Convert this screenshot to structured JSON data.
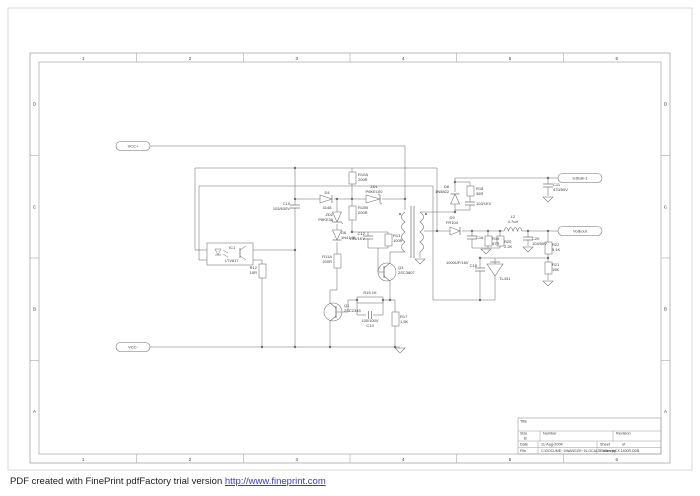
{
  "footer": {
    "text": "PDF created with FinePrint pdfFactory trial version ",
    "link_text": "http://www.fineprint.com"
  },
  "frame": {
    "columns": [
      "1",
      "2",
      "3",
      "4",
      "5",
      "6"
    ],
    "rows": [
      "D",
      "C",
      "B",
      "A"
    ]
  },
  "title_block": {
    "title_label": "Title",
    "size_label": "Size",
    "size": "B",
    "number_label": "Number",
    "revision_label": "Revision",
    "date_label": "Date",
    "date": "11-Aug-2004",
    "sheet_label": "Sheet",
    "of_label": "of",
    "file_label": "File",
    "file": "C:\\DOCUME~1\\WANGZH~1\\LOCALS~1\\Temp\\CX-1400R.DDB",
    "drawn_by_label": "Drawn by"
  },
  "schematic": {
    "ports": [
      {
        "id": "vcc-plus",
        "label": "VCC+",
        "cx": 133,
        "cy": 146,
        "w": 34
      },
      {
        "id": "vcc-minus",
        "label": "VCC-",
        "cx": 133,
        "cy": 347,
        "w": 34
      },
      {
        "id": "out-stab",
        "label": "IcStab-1",
        "cx": 580,
        "cy": 178,
        "w": 44
      },
      {
        "id": "out-volt",
        "label": "VolEout",
        "cx": 580,
        "cy": 231,
        "w": 44
      }
    ],
    "labels": [
      {
        "id": "C10",
        "x": 290,
        "y": 205,
        "anchor": "end",
        "lines": [
          "C10",
          "103/630V"
        ]
      },
      {
        "id": "D4",
        "x": 327,
        "y": 194,
        "anchor": "middle",
        "lines": [
          "D4"
        ]
      },
      {
        "id": "D4v",
        "x": 327,
        "y": 209,
        "anchor": "middle",
        "lines": [
          "4148"
        ]
      },
      {
        "id": "R10A",
        "x": 358,
        "y": 176,
        "anchor": "start",
        "lines": [
          "R10A",
          "200R"
        ]
      },
      {
        "id": "ZD1",
        "x": 374,
        "y": 188,
        "anchor": "middle",
        "lines": [
          "ZD1",
          "P6KE100"
        ]
      },
      {
        "id": "R10B",
        "x": 358,
        "y": 209,
        "anchor": "start",
        "lines": [
          "R10B",
          "200R"
        ]
      },
      {
        "id": "ZD2",
        "x": 333,
        "y": 216,
        "anchor": "end",
        "lines": [
          "ZD2",
          "P6KE30"
        ]
      },
      {
        "id": "D6",
        "x": 341,
        "y": 234,
        "anchor": "start",
        "lines": [
          "D6",
          "1N4148"
        ]
      },
      {
        "id": "R11A",
        "x": 332,
        "y": 258,
        "anchor": "end",
        "lines": [
          "R11A",
          "200R"
        ]
      },
      {
        "id": "C12",
        "x": 365,
        "y": 235,
        "anchor": "end",
        "lines": [
          "C12",
          "103/1KV"
        ]
      },
      {
        "id": "R13",
        "x": 393,
        "y": 237,
        "anchor": "start",
        "lines": [
          "R13",
          "100R"
        ]
      },
      {
        "id": "R12",
        "x": 257,
        "y": 269,
        "anchor": "end",
        "lines": [
          "R12",
          "10R"
        ]
      },
      {
        "id": "IC1",
        "x": 229,
        "y": 249,
        "anchor": "start",
        "lines": [
          "IC1"
        ]
      },
      {
        "id": "IC1v",
        "x": 225,
        "y": 262,
        "anchor": "start",
        "lines": [
          "LTV817"
        ]
      },
      {
        "id": "Q3",
        "x": 398,
        "y": 269,
        "anchor": "start",
        "lines": [
          "Q3",
          "2SC3807"
        ]
      },
      {
        "id": "Q1",
        "x": 344,
        "y": 307,
        "anchor": "start",
        "lines": [
          "Q1",
          "2SC2345"
        ]
      },
      {
        "id": "R15",
        "x": 370,
        "y": 294,
        "anchor": "middle",
        "lines": [
          "R15 1K"
        ]
      },
      {
        "id": "C13",
        "x": 370,
        "y": 322,
        "anchor": "middle",
        "lines": [
          "100/100V",
          "C13"
        ]
      },
      {
        "id": "R17",
        "x": 400,
        "y": 318,
        "anchor": "start",
        "lines": [
          "R17",
          "1.5K"
        ]
      },
      {
        "id": "D8",
        "x": 449,
        "y": 188,
        "anchor": "end",
        "lines": [
          "D8",
          "1N5822"
        ]
      },
      {
        "id": "R18",
        "x": 476,
        "y": 190,
        "anchor": "start",
        "lines": [
          "R18",
          "36R"
        ]
      },
      {
        "id": "Csnub",
        "x": 476,
        "y": 205,
        "anchor": "start",
        "lines": [
          "103/1KV"
        ]
      },
      {
        "id": "D9",
        "x": 452,
        "y": 219,
        "anchor": "middle",
        "lines": [
          "D9",
          "FR104"
        ]
      },
      {
        "id": "C16",
        "x": 476,
        "y": 239,
        "anchor": "start",
        "lines": [
          "C16"
        ]
      },
      {
        "id": "C16v",
        "x": 446,
        "y": 264,
        "anchor": "start",
        "lines": [
          "1000UF/16V"
        ]
      },
      {
        "id": "R19",
        "x": 492,
        "y": 240,
        "anchor": "start",
        "lines": [
          "R19",
          "47R"
        ]
      },
      {
        "id": "R20",
        "x": 504,
        "y": 243,
        "anchor": "start",
        "lines": [
          "R20",
          "2.2K"
        ]
      },
      {
        "id": "L2",
        "x": 513,
        "y": 218,
        "anchor": "middle",
        "lines": [
          "L2",
          "4.7uH"
        ]
      },
      {
        "id": "C20",
        "x": 532,
        "y": 240,
        "anchor": "start",
        "lines": [
          "C20",
          "104/50V"
        ]
      },
      {
        "id": "C11",
        "x": 553,
        "y": 186,
        "anchor": "start",
        "lines": [
          "C11",
          "470/50V"
        ]
      },
      {
        "id": "R22",
        "x": 552,
        "y": 246,
        "anchor": "start",
        "lines": [
          "R22",
          "5.1K"
        ]
      },
      {
        "id": "R21",
        "x": 552,
        "y": 266,
        "anchor": "start",
        "lines": [
          "R21",
          "15K"
        ]
      },
      {
        "id": "C18",
        "x": 477,
        "y": 267,
        "anchor": "end",
        "lines": [
          "C18"
        ]
      },
      {
        "id": "TL431",
        "x": 499,
        "y": 280,
        "anchor": "start",
        "lines": [
          "TL431"
        ]
      }
    ],
    "wires": [
      [
        150,
        146,
        405,
        146
      ],
      [
        405,
        146,
        405,
        210
      ],
      [
        195,
        168,
        437,
        168
      ],
      [
        195,
        168,
        195,
        250
      ],
      [
        195,
        250,
        207,
        250
      ],
      [
        437,
        168,
        437,
        231
      ],
      [
        199,
        186,
        433,
        186
      ],
      [
        199,
        186,
        199,
        260
      ],
      [
        199,
        260,
        207,
        260
      ],
      [
        433,
        186,
        433,
        300
      ],
      [
        433,
        300,
        495,
        300
      ],
      [
        253,
        250,
        295,
        250
      ],
      [
        253,
        260,
        262,
        260
      ],
      [
        262,
        260,
        262,
        264
      ],
      [
        262,
        278,
        262,
        347
      ],
      [
        295,
        168,
        295,
        205
      ],
      [
        295,
        208,
        295,
        347
      ],
      [
        295,
        199,
        320,
        199
      ],
      [
        334,
        199,
        366,
        199
      ],
      [
        382,
        199,
        405,
        199
      ],
      [
        352,
        168,
        352,
        172
      ],
      [
        352,
        184,
        352,
        206
      ],
      [
        352,
        220,
        352,
        232
      ],
      [
        352,
        232,
        388,
        232
      ],
      [
        368,
        232,
        368,
        236
      ],
      [
        368,
        239,
        368,
        248
      ],
      [
        388,
        232,
        388,
        234
      ],
      [
        388,
        246,
        388,
        248
      ],
      [
        368,
        248,
        388,
        248
      ],
      [
        378,
        248,
        378,
        272
      ],
      [
        378,
        272,
        384,
        272
      ],
      [
        337,
        199,
        337,
        212
      ],
      [
        337,
        224,
        337,
        230
      ],
      [
        337,
        242,
        337,
        254
      ],
      [
        337,
        268,
        337,
        290
      ],
      [
        337,
        290,
        330,
        290
      ],
      [
        330,
        290,
        330,
        303
      ],
      [
        336,
        312,
        348,
        312
      ],
      [
        348,
        312,
        348,
        300
      ],
      [
        348,
        300,
        357,
        300
      ],
      [
        330,
        321,
        330,
        347
      ],
      [
        390,
        263,
        390,
        252
      ],
      [
        390,
        252,
        405,
        252
      ],
      [
        390,
        281,
        390,
        300
      ],
      [
        383,
        300,
        390,
        300
      ],
      [
        390,
        300,
        395,
        300
      ],
      [
        395,
        300,
        395,
        312
      ],
      [
        395,
        326,
        395,
        347
      ],
      [
        357,
        300,
        357,
        315
      ],
      [
        357,
        315,
        366,
        315
      ],
      [
        373,
        315,
        383,
        315
      ],
      [
        383,
        315,
        383,
        300
      ],
      [
        150,
        347,
        400,
        347
      ],
      [
        420,
        212,
        455,
        212
      ],
      [
        455,
        212,
        455,
        204
      ],
      [
        455,
        192,
        455,
        178
      ],
      [
        455,
        178,
        558,
        178
      ],
      [
        455,
        210,
        470,
        210
      ],
      [
        470,
        210,
        470,
        205
      ],
      [
        470,
        202,
        470,
        196
      ],
      [
        470,
        186,
        470,
        182
      ],
      [
        470,
        182,
        455,
        182
      ],
      [
        420,
        252,
        420,
        258
      ],
      [
        424,
        231,
        450,
        231
      ],
      [
        462,
        231,
        504,
        231
      ],
      [
        522,
        231,
        558,
        231
      ],
      [
        472,
        231,
        472,
        236
      ],
      [
        472,
        239,
        472,
        248
      ],
      [
        488,
        231,
        488,
        236
      ],
      [
        488,
        246,
        488,
        248
      ],
      [
        500,
        231,
        500,
        236
      ],
      [
        500,
        246,
        500,
        248
      ],
      [
        472,
        248,
        500,
        248
      ],
      [
        528,
        231,
        528,
        237
      ],
      [
        528,
        240,
        528,
        246
      ],
      [
        548,
        231,
        548,
        242
      ],
      [
        548,
        254,
        548,
        262
      ],
      [
        548,
        274,
        548,
        280
      ],
      [
        548,
        258,
        480,
        258
      ],
      [
        495,
        258,
        495,
        264
      ],
      [
        495,
        276,
        495,
        300
      ],
      [
        480,
        258,
        480,
        268
      ],
      [
        480,
        271,
        480,
        300
      ],
      [
        548,
        178,
        548,
        184
      ],
      [
        548,
        187,
        548,
        196
      ]
    ],
    "resistors": [
      {
        "id": "R10A",
        "x": 349,
        "y": 172,
        "w": 7,
        "h": 12
      },
      {
        "id": "R10B",
        "x": 349,
        "y": 206,
        "w": 7,
        "h": 14
      },
      {
        "id": "R11A",
        "x": 334,
        "y": 254,
        "w": 7,
        "h": 14
      },
      {
        "id": "R13",
        "x": 385,
        "y": 234,
        "w": 7,
        "h": 12
      },
      {
        "id": "R12",
        "x": 259,
        "y": 264,
        "w": 7,
        "h": 14
      },
      {
        "id": "R15",
        "x": 357,
        "y": 297,
        "w": 26,
        "h": 6
      },
      {
        "id": "R17",
        "x": 392,
        "y": 312,
        "w": 7,
        "h": 14
      },
      {
        "id": "R18",
        "x": 467,
        "y": 186,
        "w": 7,
        "h": 10
      },
      {
        "id": "R19",
        "x": 485,
        "y": 236,
        "w": 7,
        "h": 10
      },
      {
        "id": "R20",
        "x": 497,
        "y": 236,
        "w": 7,
        "h": 10
      },
      {
        "id": "R22",
        "x": 545,
        "y": 242,
        "w": 7,
        "h": 12
      },
      {
        "id": "R21",
        "x": 545,
        "y": 262,
        "w": 7,
        "h": 12
      }
    ],
    "capacitors": [
      {
        "id": "C10",
        "x": 295,
        "y": 206.5,
        "orient": "v"
      },
      {
        "id": "C12",
        "x": 368,
        "y": 237.5,
        "orient": "v"
      },
      {
        "id": "C13",
        "x": 370,
        "y": 315,
        "orient": "h"
      },
      {
        "id": "C16",
        "x": 472,
        "y": 237.5,
        "orient": "v"
      },
      {
        "id": "C20",
        "x": 528,
        "y": 238.5,
        "orient": "v"
      },
      {
        "id": "C11",
        "x": 548,
        "y": 185.5,
        "orient": "v"
      },
      {
        "id": "Csnub",
        "x": 470,
        "y": 203.5,
        "orient": "v"
      },
      {
        "id": "C18",
        "x": 480,
        "y": 269.5,
        "orient": "v"
      }
    ],
    "diodes": [
      {
        "id": "D4",
        "x": 320,
        "y": 199,
        "dir": "right",
        "len": 14,
        "zener": false
      },
      {
        "id": "ZD1",
        "x": 366,
        "y": 199,
        "dir": "right",
        "len": 16,
        "zener": true
      },
      {
        "id": "ZD2",
        "x": 337,
        "y": 212,
        "dir": "down",
        "len": 12,
        "zener": true
      },
      {
        "id": "D6",
        "x": 337,
        "y": 230,
        "dir": "down",
        "len": 12,
        "zener": false
      },
      {
        "id": "D8",
        "x": 455,
        "y": 204,
        "dir": "up",
        "len": 12,
        "zener": false
      },
      {
        "id": "D9",
        "x": 450,
        "y": 231,
        "dir": "right",
        "len": 12,
        "zener": false
      }
    ],
    "transistors": [
      {
        "id": "Q1",
        "cx": 333,
        "cy": 312,
        "side": "right"
      },
      {
        "id": "Q3",
        "cx": 387,
        "cy": 272,
        "side": "left"
      }
    ],
    "grounds": [
      [
        400,
        348
      ],
      [
        420,
        259
      ],
      [
        548,
        197
      ],
      [
        486,
        249
      ],
      [
        528,
        247
      ],
      [
        548,
        281
      ]
    ],
    "dots": [
      [
        295,
        168
      ],
      [
        295,
        199
      ],
      [
        295,
        250
      ],
      [
        295,
        347
      ],
      [
        337,
        199
      ],
      [
        352,
        199
      ],
      [
        405,
        199
      ],
      [
        262,
        347
      ],
      [
        330,
        347
      ],
      [
        395,
        347
      ],
      [
        437,
        231
      ],
      [
        455,
        212
      ],
      [
        455,
        182
      ],
      [
        472,
        231
      ],
      [
        488,
        231
      ],
      [
        500,
        231
      ],
      [
        528,
        231
      ],
      [
        548,
        231
      ],
      [
        548,
        178
      ],
      [
        548,
        258
      ],
      [
        480,
        258
      ],
      [
        480,
        300
      ],
      [
        390,
        300
      ],
      [
        357,
        300
      ],
      [
        383,
        300
      ],
      [
        352,
        232
      ]
    ],
    "transformer": {
      "px": 405,
      "sx": 420,
      "top": 212,
      "bot": 252,
      "core_top": 206,
      "core_bot": 258
    },
    "inductor": {
      "id": "L2",
      "x1": 504,
      "x2": 522,
      "y": 231
    },
    "opto": {
      "id": "IC1",
      "x": 207,
      "y": 243,
      "w": 46,
      "h": 22
    },
    "tl431": {
      "x": 495,
      "y": 264
    }
  }
}
